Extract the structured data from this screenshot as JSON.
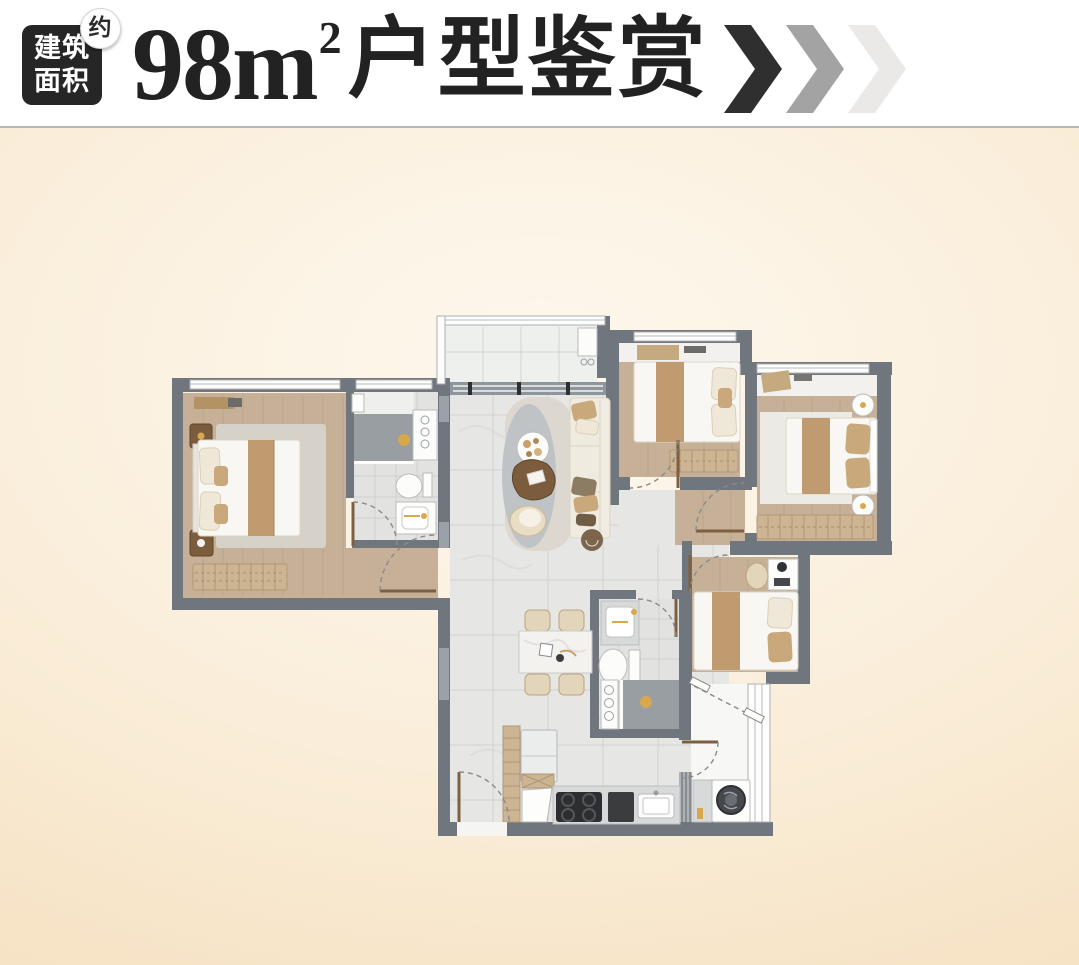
{
  "header": {
    "badge": {
      "line1": "建筑",
      "line2": "面积",
      "approx": "约"
    },
    "title": {
      "number": "98",
      "unit": "m",
      "sup": "2",
      "text": "户型鉴赏"
    }
  },
  "colors": {
    "page_center": "#fdf8ee",
    "page_mid": "#faeeda",
    "page_edge": "#f5ddba",
    "header_bg": "#ffffff",
    "divider": "#b9b7b4",
    "badge_bg": "#262626",
    "badge_text": "#ffffff",
    "title_text": "#222222",
    "chevron_1": "#2f2f2f",
    "chevron_2": "#a3a3a3",
    "chevron_3": "#eae9e7",
    "wall": "#70767e",
    "wall_light": "#9ba1a8",
    "wood_floor": "#c6b097",
    "tile_floor": "#e6e7e5",
    "bath_floor": "#e2e3e1",
    "accent_gold": "#d9a84c"
  }
}
